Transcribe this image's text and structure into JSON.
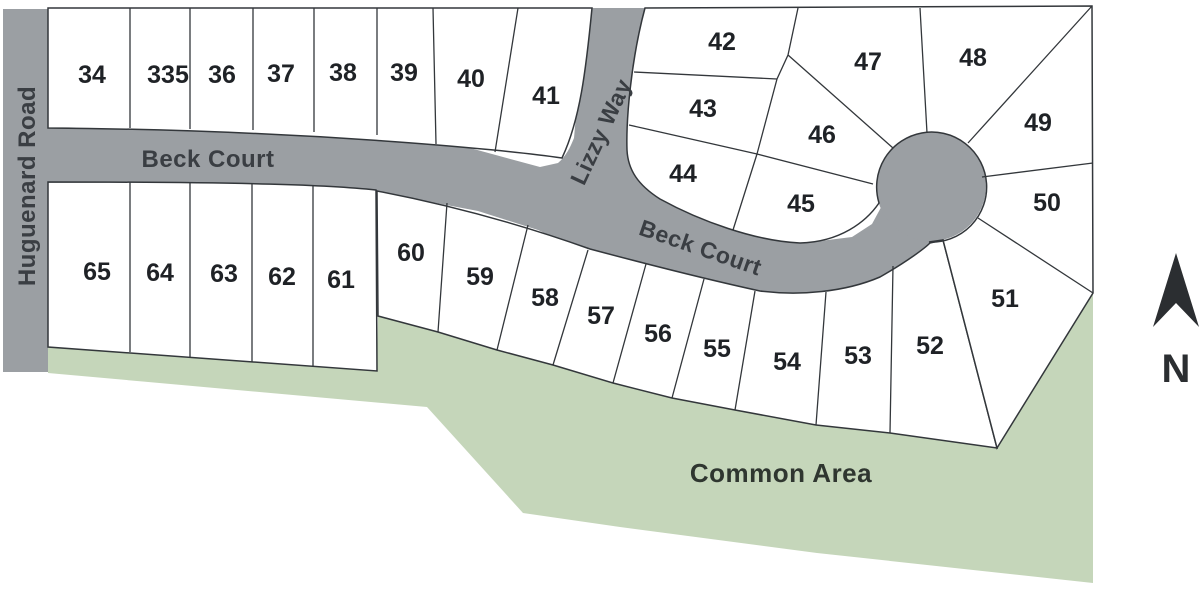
{
  "roads": {
    "huguenard": "Huguenard Road",
    "beck_court": "Beck Court",
    "lizzy": "Lizzy Way"
  },
  "areas": {
    "common": "Common Area"
  },
  "compass": {
    "north": "N"
  },
  "lots": [
    {
      "number": "34"
    },
    {
      "number": "335"
    },
    {
      "number": "36"
    },
    {
      "number": "37"
    },
    {
      "number": "38"
    },
    {
      "number": "39"
    },
    {
      "number": "40"
    },
    {
      "number": "41"
    },
    {
      "number": "42"
    },
    {
      "number": "43"
    },
    {
      "number": "44"
    },
    {
      "number": "45"
    },
    {
      "number": "46"
    },
    {
      "number": "47"
    },
    {
      "number": "48"
    },
    {
      "number": "49"
    },
    {
      "number": "50"
    },
    {
      "number": "51"
    },
    {
      "number": "52"
    },
    {
      "number": "53"
    },
    {
      "number": "54"
    },
    {
      "number": "55"
    },
    {
      "number": "56"
    },
    {
      "number": "57"
    },
    {
      "number": "58"
    },
    {
      "number": "59"
    },
    {
      "number": "60"
    },
    {
      "number": "61"
    },
    {
      "number": "62"
    },
    {
      "number": "63"
    },
    {
      "number": "64"
    },
    {
      "number": "65"
    }
  ],
  "colors": {
    "background": "#FFFFFF",
    "road": "#9B9FA3",
    "common_area": "#C5D6BA",
    "parcel_fill": "#FFFFFF",
    "parcel_outline": "#33373B",
    "road_label": "#3A3E43",
    "lot_number": "#1F2226",
    "common_label": "#2F3630",
    "north_arrow": "#2B2E31"
  }
}
